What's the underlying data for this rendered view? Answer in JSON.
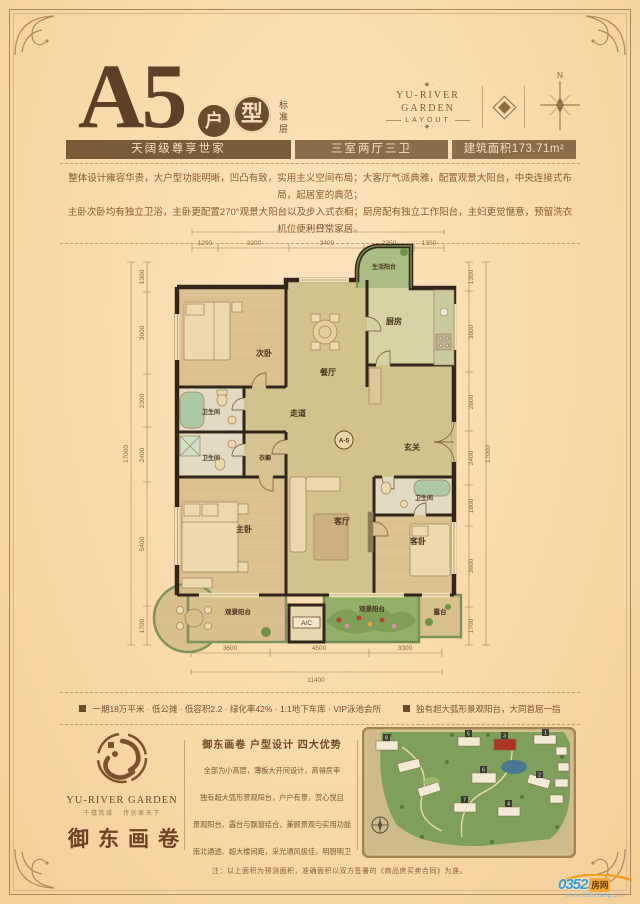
{
  "header": {
    "unit": "A5",
    "badges": [
      "户",
      "型"
    ],
    "subtitle": "标准层",
    "brand": {
      "name1": "YU-RIVER",
      "name2": "GARDEN",
      "name3": "LAYOUT",
      "ornament": "·◆·"
    },
    "compass_n": "N"
  },
  "info_bars": [
    "天阔级尊享世家",
    "三室两厅三卫",
    "建筑面积173.71m²"
  ],
  "description": {
    "line1": "整体设计雍容华贵，大户型功能明晰，凹凸有致，实用主义空间布局；大客厅气派典雅，配置观景大阳台，中央连接式布局，起居室的典范；",
    "line2": "主卧次卧均有独立卫浴，主卧更配置270°观景大阳台以及步入式衣橱；厨房配有独立工作阳台，主妇更觉惬意，预留洗衣机位便利日常家居。"
  },
  "floorplan": {
    "rooms": {
      "service_balcony": "生活阳台",
      "kitchen": "厨房",
      "bedroom2": "次卧",
      "dining": "餐厅",
      "corridor": "走道",
      "bath1": "卫生间",
      "bath2": "卫生间",
      "bath3": "卫生间",
      "wardrobe": "衣橱",
      "entry": "玄关",
      "master": "主卧",
      "living": "客厅",
      "guest": "客卧",
      "view_balcony_left": "观景阳台",
      "view_balcony_center": "观景阳台",
      "terrace": "露台",
      "ac": "A/C",
      "unit_badge": "A-5"
    },
    "dims": {
      "top_total": "11400",
      "top_segments": [
        "1200",
        "3200",
        "3400",
        "2250",
        "1350"
      ],
      "bottom_segments": [
        "3600",
        "4500",
        "3300"
      ],
      "bottom_total": "11400",
      "left_segments": [
        "1300",
        "3600",
        "2300",
        "2400",
        "5400",
        "1700"
      ],
      "left_total": "17000",
      "right_segments": [
        "1300",
        "3600",
        "2600",
        "2400",
        "1800",
        "3600",
        "1700"
      ],
      "right_total": "17000"
    }
  },
  "features": {
    "item1": "一期18万平米 · 低公摊 · 低容积2.2 · 绿化率42% · 1:1地下车库 · VIP泳池会所",
    "item2": "独有超大弧形景观阳台，大同首屈一指"
  },
  "footer": {
    "logo": {
      "en": "YU-RIVER GARDEN",
      "tagline": "千禧筑城 · 传创家天下",
      "cn": "御东画卷"
    },
    "advantages": {
      "title": "御东画卷 户型设计 四大优势",
      "lines": [
        "全部为小高层，薄板大开间设计，高得房率",
        "独有超大弧形景观阳台，户户有景，赏心悦目",
        "景观阳台、露台与飘窗结合，兼顾景观与实用功能",
        "南北通透、超大楼间距，采光通风极佳，明厨明卫"
      ]
    },
    "siteplan_numbers": [
      "1",
      "2",
      "3",
      "4",
      "5",
      "6",
      "7",
      "8"
    ],
    "note": "注：以上面积为预测面积，准确面积以双方签署的《商品房买卖合同》为准。",
    "watermark": {
      "part1": "0352",
      "part2": "房网",
      "url": "www.0352fang.com"
    }
  }
}
